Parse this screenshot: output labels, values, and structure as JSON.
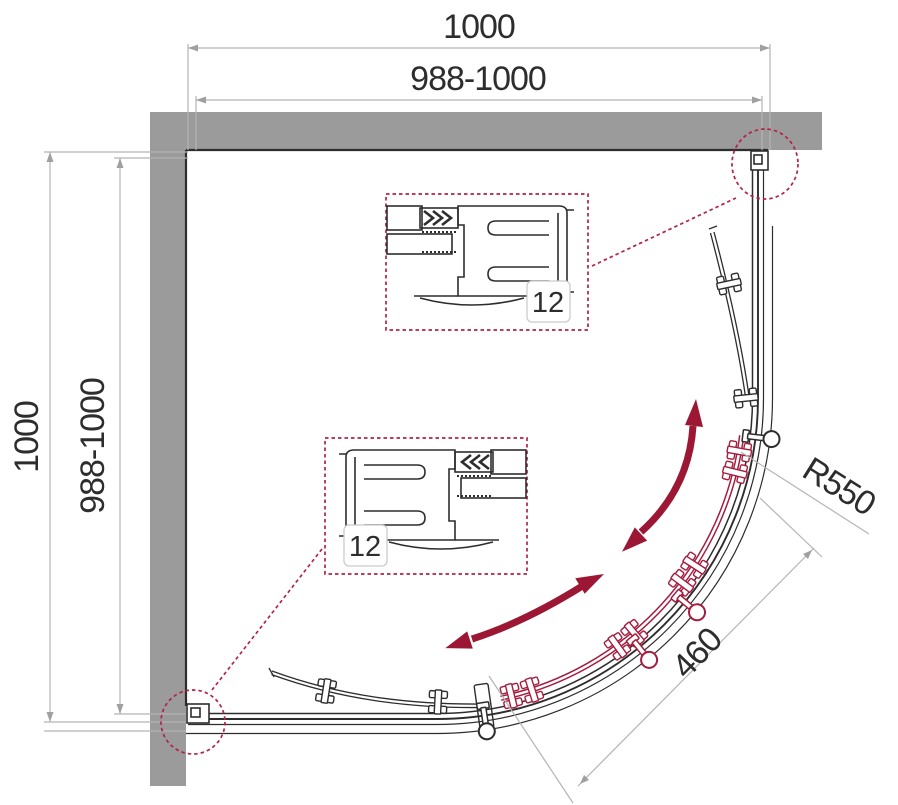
{
  "dimensions": {
    "top": {
      "overall": "1000",
      "adjustable": "988-1000"
    },
    "left": {
      "overall": "1000",
      "adjustable": "988-1000"
    },
    "radius": "R550",
    "door_opening": "460"
  },
  "callouts": {
    "top_profile": "12",
    "bottom_profile": "12"
  },
  "colors": {
    "wall": "#9b9b9b",
    "ink": "#2d2d2d",
    "dim": "#b4b4b4",
    "crimson": "#9c1733",
    "crimson_light": "#b22347",
    "door_red": "#a51c3e"
  }
}
